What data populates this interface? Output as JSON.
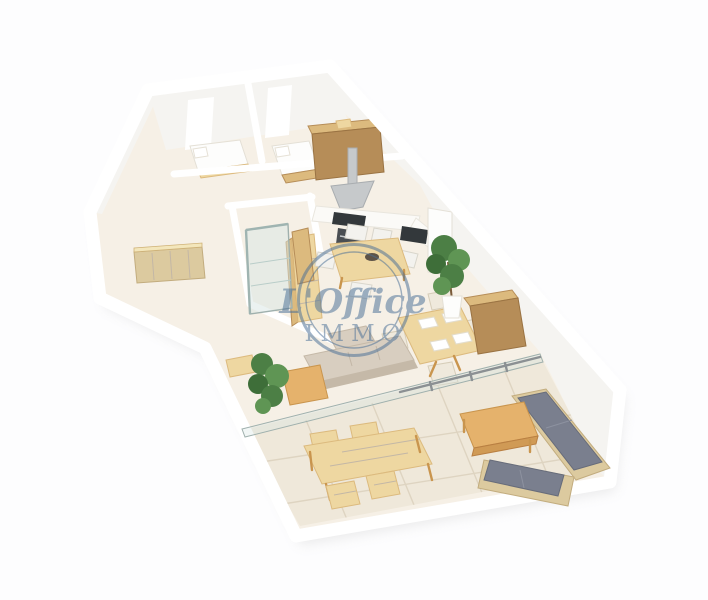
{
  "watermark": {
    "script": "L'Office",
    "word": "IMMO"
  },
  "scene": {
    "type": "3d-apartment-floor-plan-render",
    "rooms": [
      "bedroom-1",
      "bedroom-2",
      "bathroom",
      "hallway",
      "kitchen",
      "dining-area",
      "living-room",
      "terrace"
    ],
    "furniture": [
      "single-bed",
      "double-bed",
      "wardrobe",
      "range-hood",
      "cooktop",
      "oven",
      "kitchen-counter",
      "kitchen-sink",
      "fridge-column",
      "tall-cabinet",
      "kitchen-table",
      "kitchen-chairs",
      "shower-cabin",
      "bathroom-shelf",
      "wicker-sideboard",
      "dining-table",
      "dining-chairs",
      "sideboard",
      "potted-plant-kitchen",
      "potted-plant-living",
      "sofa-indoor",
      "coffee-table-indoor",
      "wood-bench",
      "sliding-glass-doors",
      "terrace-dining-table",
      "terrace-chairs",
      "outdoor-sofa",
      "outdoor-coffee-table"
    ]
  },
  "colors": {
    "page_bg": "#fdfdfe",
    "floor": "#f6f0e6",
    "tile": "#efe8da",
    "grout": "#ded4c1",
    "wall": "#ffffff",
    "wall_face": "#f5f4f1",
    "shadow": "#d4d4d4",
    "counter": "#fbfaf7",
    "counter_line": "#e9e6de",
    "wood_light": "#eed7a1",
    "wood_mid": "#dcba7e",
    "wood_deep": "#b68d58",
    "wood_warm": "#e5b26c",
    "wood_warm_dark": "#c9954e",
    "sofa_beige": "#d8cec0",
    "sofa_beige_dark": "#c5b9a8",
    "cushion_gray": "#7a7f8e",
    "cushion_gray_dark": "#676c7a",
    "rattan": "#dcca9f",
    "rattan_dark": "#c2ac7e",
    "green": "#4c7f45",
    "green_light": "#5f9554",
    "green_dark": "#3e6e39",
    "appliance_dark": "#33383b",
    "appliance_mid": "#4a4e52",
    "steel": "#c6c9cb",
    "steel_dark": "#a9adb0",
    "glass": "#d8e6e3",
    "glass_frame": "#9fb0ad",
    "door_frame": "#8b9093",
    "chair_white": "#f3f2ee",
    "chair_white_line": "#d9d6cc",
    "chair_cream": "#efe9dc",
    "chair_cream_line": "#d6cdb8",
    "white_furn": "#fdfdfc",
    "watermark": "#4a6f96"
  }
}
